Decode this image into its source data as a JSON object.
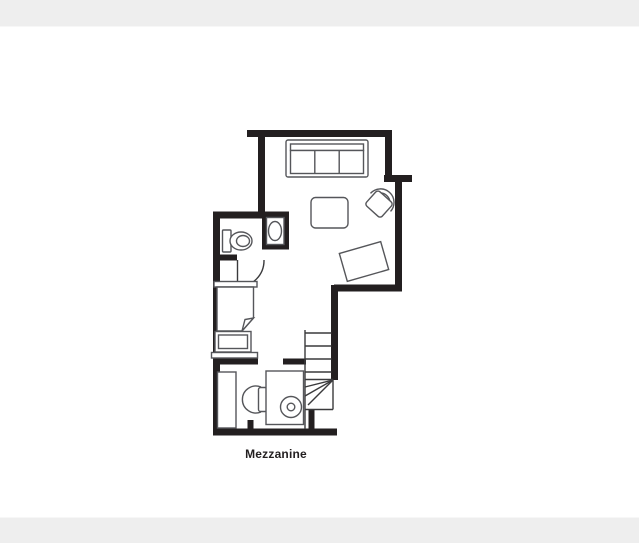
{
  "page": {
    "background_strip_color": "#eeeeee",
    "canvas_color": "#ffffff"
  },
  "plan": {
    "label": "Mezzanine",
    "wall_color": "#231f20",
    "furniture_line_color": "#55565a",
    "stair_line_color": "#3a3a3c"
  },
  "furniture_icons": [
    "sofa-icon",
    "armchair-icon",
    "coffee-table-icon",
    "side-table-icon",
    "toilet-icon",
    "sink-icon",
    "bathroom-door-icon",
    "bed-icon",
    "chest-of-drawers-icon",
    "shelf-icon",
    "wardrobe-icon",
    "desk-icon",
    "desk-chair-icon",
    "stool-icon",
    "staircase-icon"
  ]
}
